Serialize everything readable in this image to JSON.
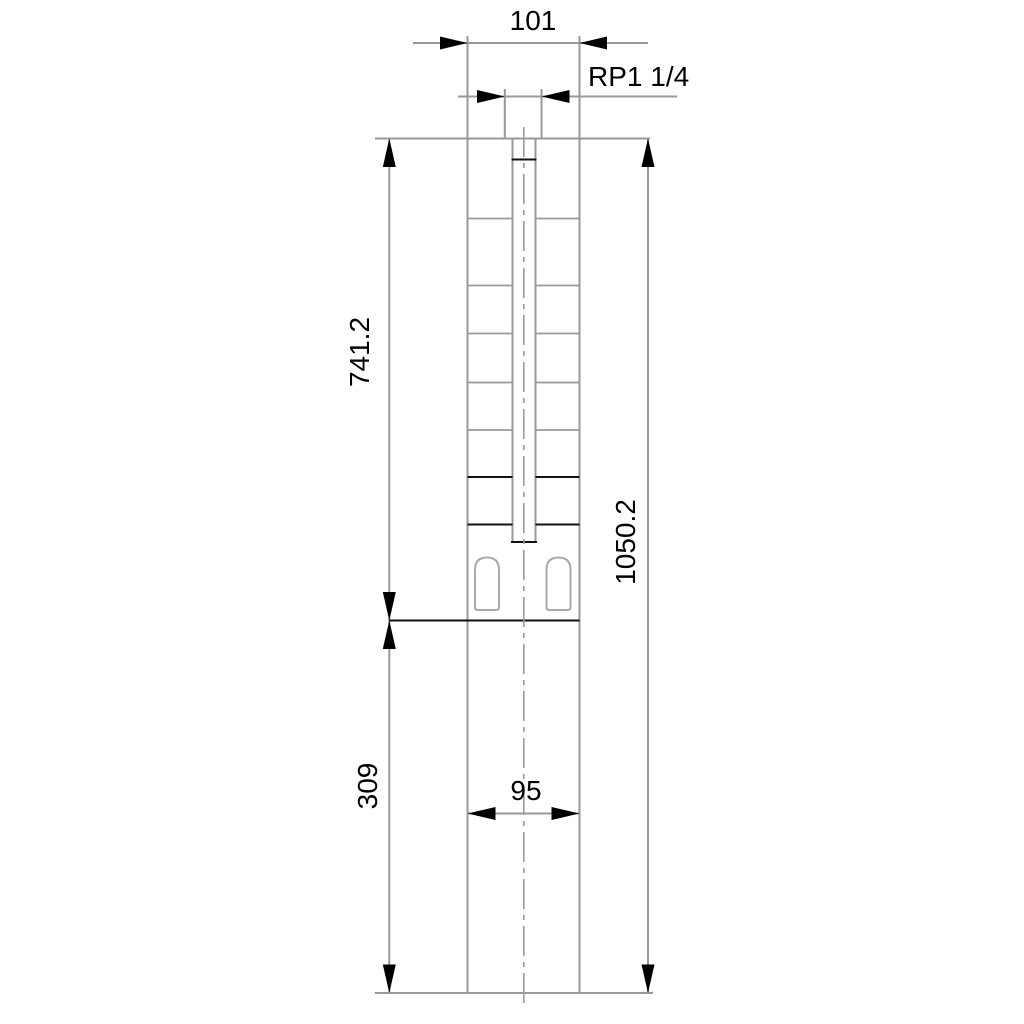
{
  "drawing": {
    "type": "technical-dimension-drawing",
    "subject": "submersible-borehole-pump-outline",
    "labels": {
      "width_top": "101",
      "thread": "RP1 1/4",
      "pump_section_length": "741.2",
      "total_length": "1050.2",
      "motor_section_length": "309",
      "width_bottom": "95"
    },
    "colors": {
      "background": "#ffffff",
      "outline_gray": "#999999",
      "detail_black": "#000000",
      "text": "#000000"
    }
  }
}
